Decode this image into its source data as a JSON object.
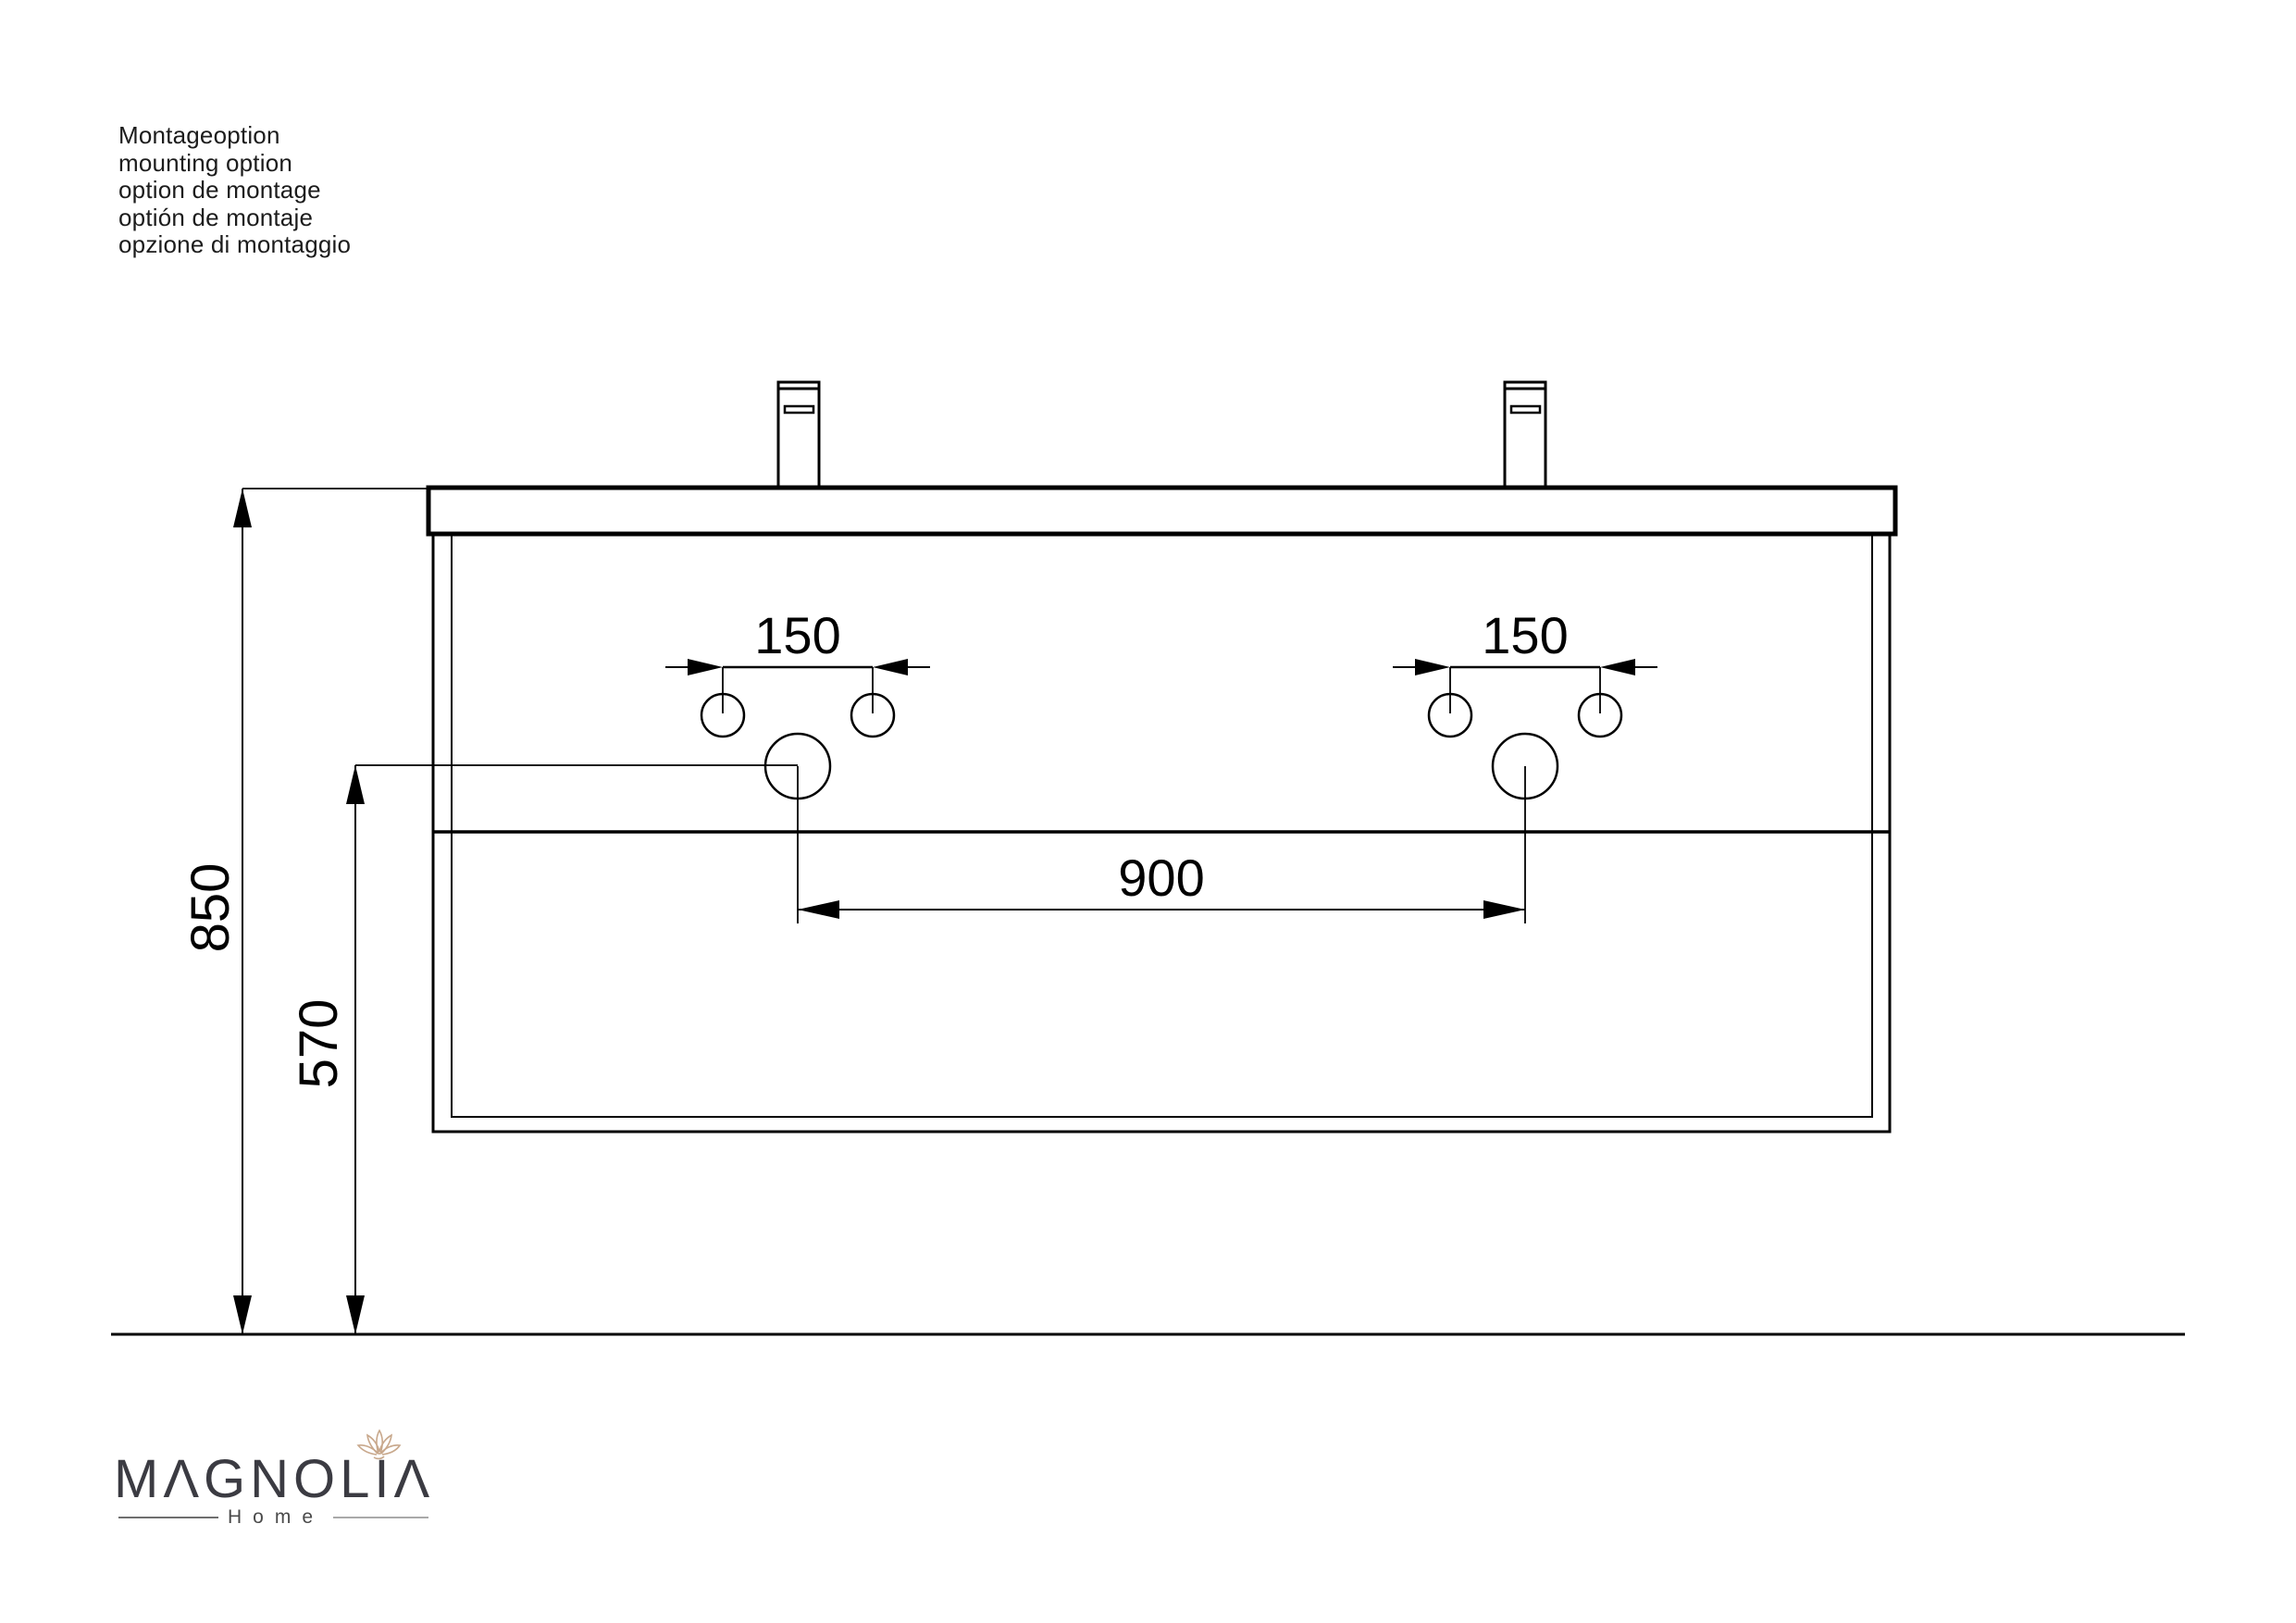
{
  "notes": {
    "lines": [
      "Montageoption",
      "mounting option",
      "option de montage",
      "optión de montaje",
      "opzione di montaggio"
    ]
  },
  "dimensions": {
    "overall_height": "850",
    "drain_height": "570",
    "faucet_holes_left": "150",
    "faucet_holes_right": "150",
    "drain_spacing": "900"
  },
  "logo": {
    "brand": "MΛGNOLIΛ",
    "subtitle": "Home",
    "brand_color": "#3b3b42",
    "flower_color": "#c8a88c"
  },
  "colors": {
    "line": "#000000",
    "background": "#ffffff"
  }
}
